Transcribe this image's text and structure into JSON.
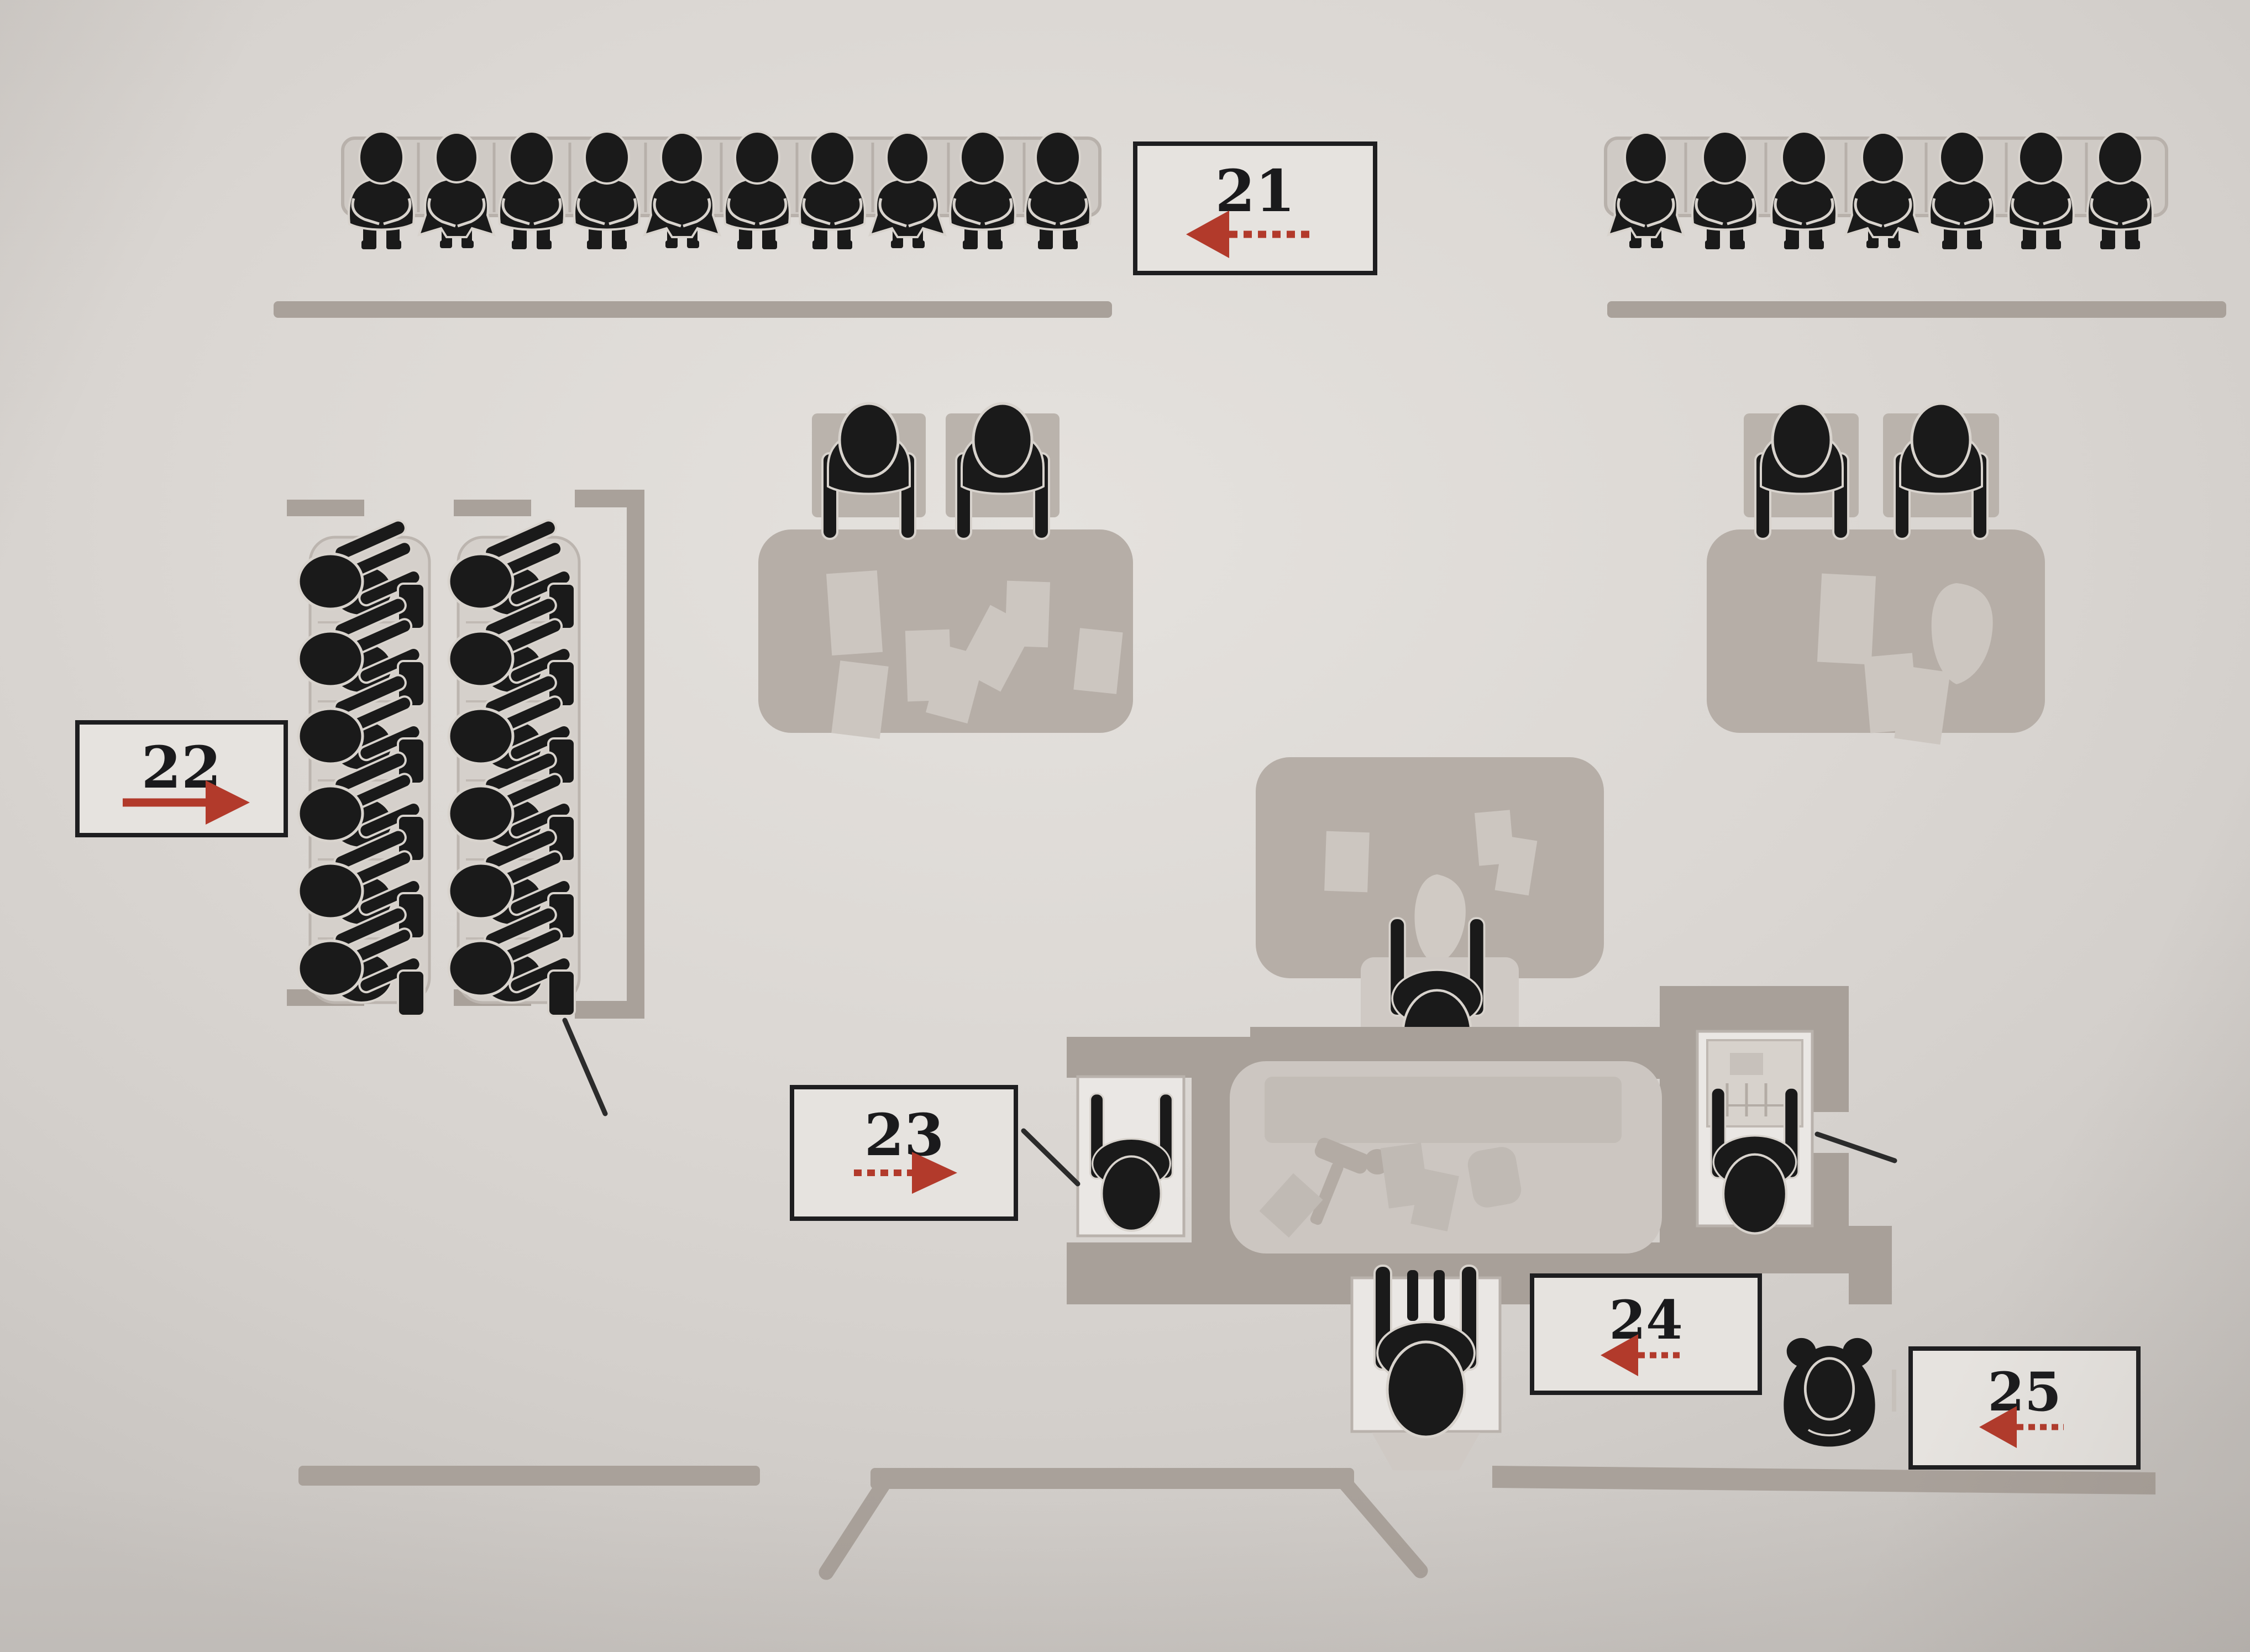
{
  "document": {
    "type": "courtroom floor-plan diagram",
    "style": "scanned book page, grayscale figures with red numbered callout arrows"
  },
  "labels": {
    "l21": {
      "number": "21",
      "arrow_direction": "left"
    },
    "l22": {
      "number": "22",
      "arrow_direction": "right"
    },
    "l23": {
      "number": "23",
      "arrow_direction": "right"
    },
    "l24": {
      "number": "24",
      "arrow_direction": "left"
    },
    "l25": {
      "number": "25",
      "arrow_direction": "left"
    }
  },
  "scene": {
    "gallery_left": {
      "count": 10,
      "people": [
        "m",
        "f",
        "m",
        "m",
        "f",
        "m",
        "m",
        "f",
        "m",
        "m"
      ]
    },
    "gallery_right": {
      "count": 7,
      "people": [
        "f",
        "m",
        "m",
        "f",
        "m",
        "m",
        "m"
      ]
    },
    "jury_box": {
      "columns": 2,
      "jurors_per_column": 6,
      "total_jurors": 12,
      "left_column": {
        "people": [
          "j",
          "j",
          "j",
          "j",
          "j",
          "j"
        ]
      },
      "right_column": {
        "people": [
          "j",
          "j",
          "j",
          "j",
          "j",
          "j"
        ]
      }
    },
    "counsel_table_left": {
      "people": [
        "c",
        "c"
      ],
      "papers": 7
    },
    "counsel_table_right": {
      "people": [
        "c",
        "c"
      ],
      "papers": 4
    },
    "center_table": {
      "people": 1,
      "papers": 4
    },
    "judge_bench": {
      "gavel": true,
      "papers": 4,
      "clerk_seat_occupied": true,
      "witness_stand_occupied": true
    },
    "court_reporter_present": true,
    "bailiff_standing_present": true,
    "leader_lines": 3,
    "doorway_position": "bottom-center"
  },
  "colors": {
    "arrow_red": "#b23a2b",
    "figure_black": "#1a1a1a",
    "wall_gray": "#a9a19a",
    "furniture_gray": "#b6aea7",
    "paper_background": "#dad6d2",
    "label_border": "#1e1e20"
  }
}
